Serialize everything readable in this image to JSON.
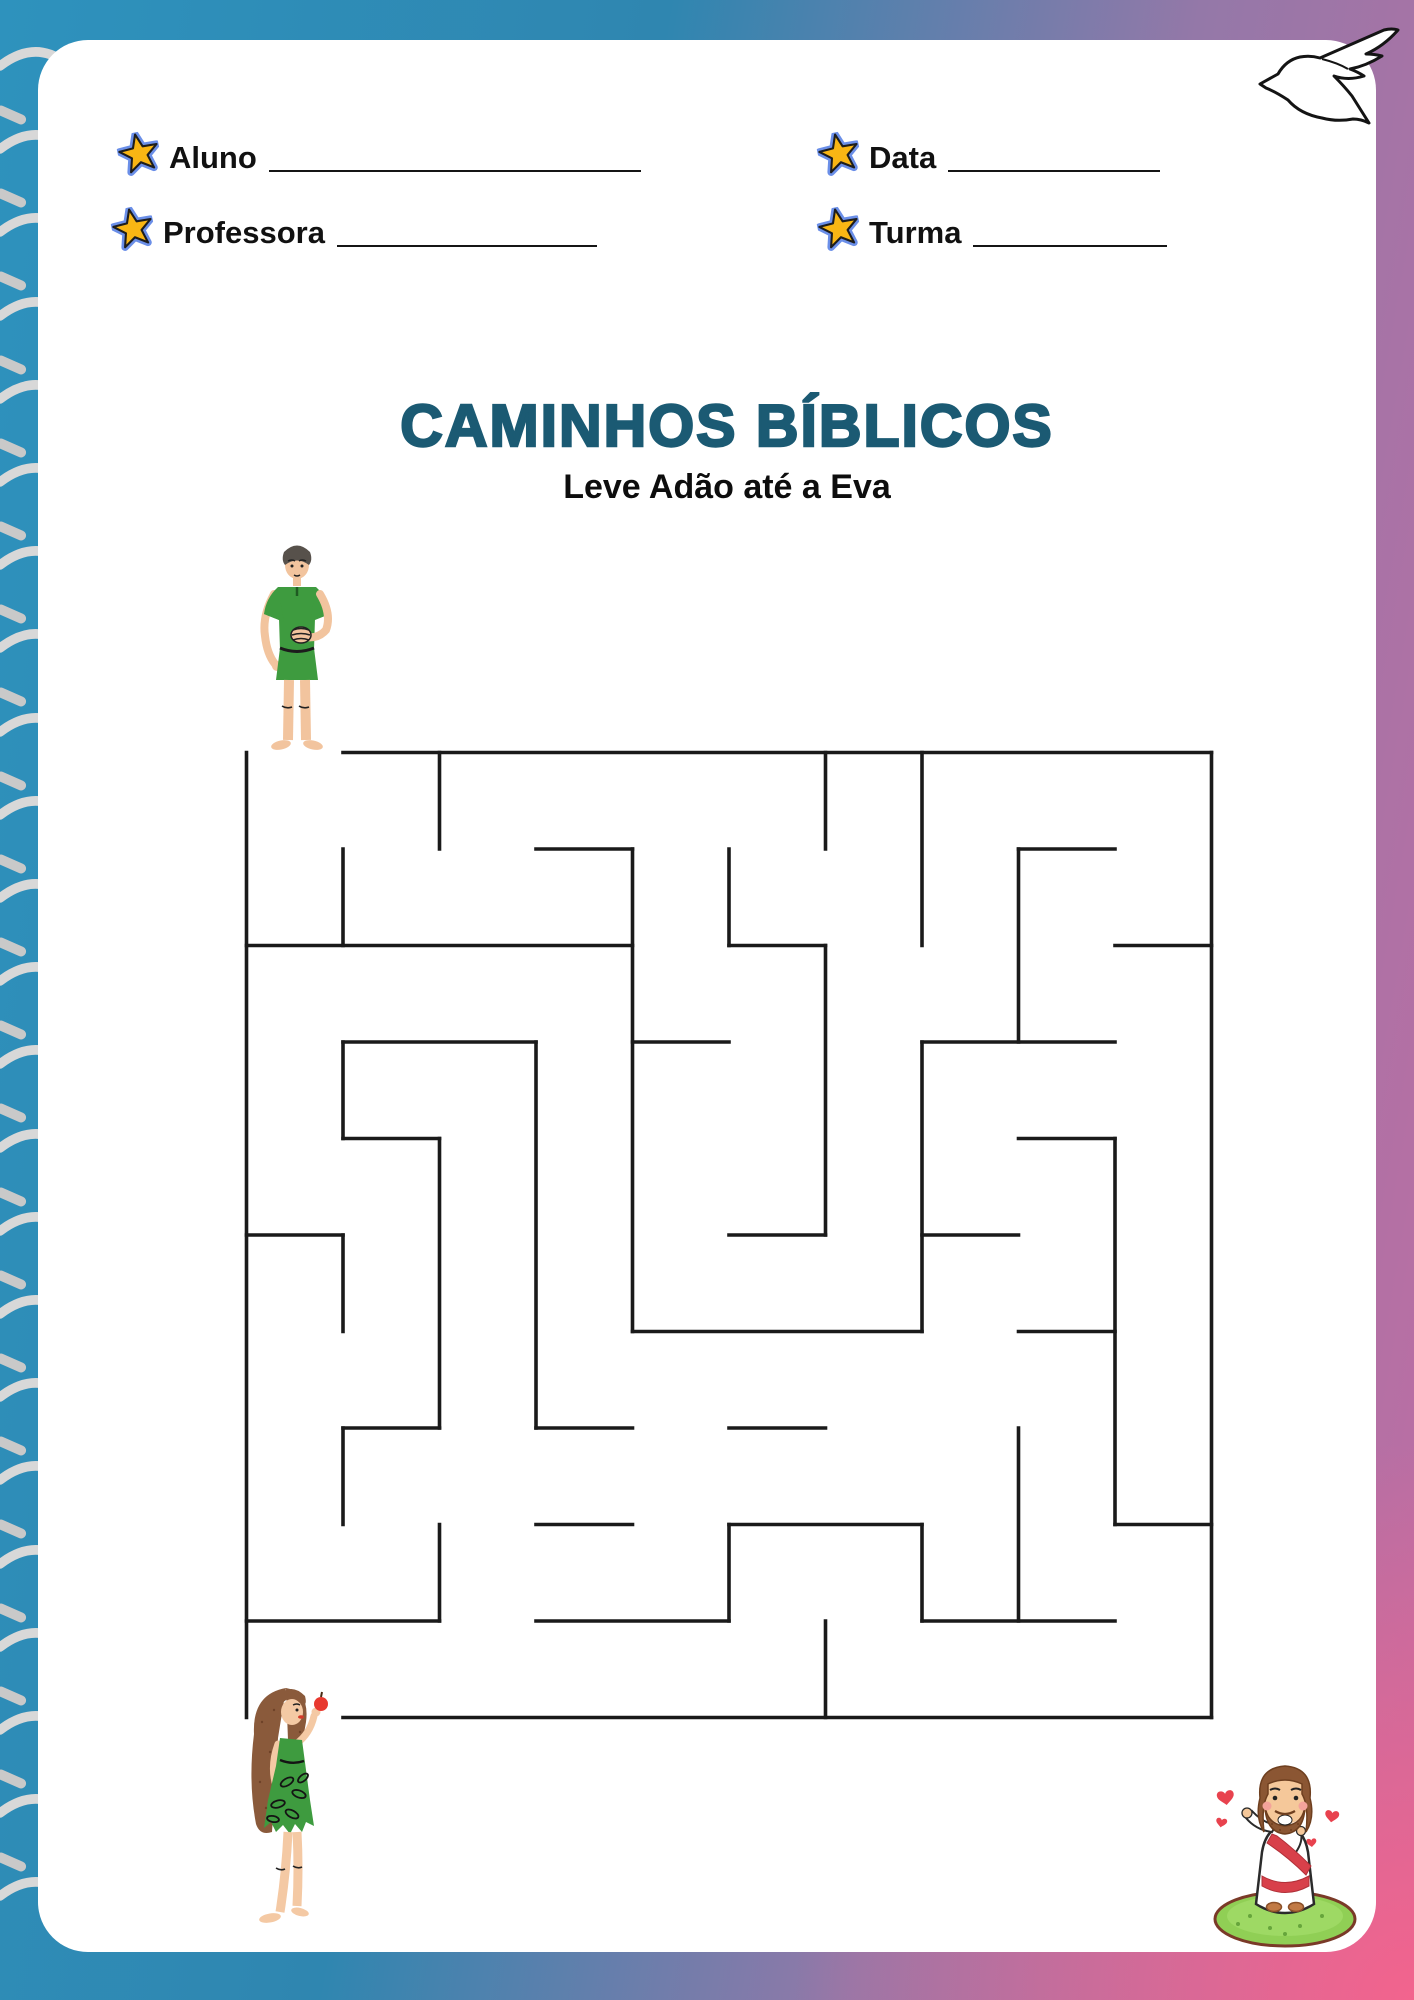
{
  "doc": {
    "kind": "printable-maze-worksheet",
    "language": "pt-BR"
  },
  "colors": {
    "bg_blue": "#2E92BD",
    "bg_pink_muted": "#C06DA3",
    "bg_pink_vivid": "#F5638C",
    "paper": "#FFFFFF",
    "title_teal": "#1B5A73",
    "text": "#111111",
    "maze_wall": "#1A1A1A",
    "star_fill": "#F9B614",
    "star_ring": "#6B8FE8",
    "wire": "#D8D8D8",
    "ring_hole": "#141414",
    "tunic_green": "#3E9B3F",
    "skin": "#F2C49E",
    "apple_red": "#E8392F",
    "heart_red": "#E8424E",
    "sash_red": "#D8404A",
    "grass_green": "#90CF55"
  },
  "header": {
    "fields": [
      {
        "id": "aluno",
        "label": "Aluno"
      },
      {
        "id": "professora",
        "label": "Professora"
      },
      {
        "id": "data",
        "label": "Data"
      },
      {
        "id": "turma",
        "label": "Turma"
      }
    ]
  },
  "title": "CAMINHOS BÍBLICOS",
  "subtitle": "Leve Adão até a Eva",
  "maze": {
    "cols": 10,
    "rows": 10,
    "cell": 96.5,
    "entrance": "top-left (above first column, Adam)",
    "exit": "bottom-left (below first column, Eve)",
    "h_walls": [
      [
        0,
        1,
        10
      ],
      [
        1,
        3,
        4
      ],
      [
        1,
        8,
        9
      ],
      [
        2,
        0,
        4
      ],
      [
        2,
        5,
        6
      ],
      [
        2,
        9,
        10
      ],
      [
        3,
        1,
        3
      ],
      [
        3,
        4,
        5
      ],
      [
        3,
        7,
        9
      ],
      [
        4,
        1,
        2
      ],
      [
        4,
        8,
        9
      ],
      [
        5,
        0,
        1
      ],
      [
        5,
        5,
        6
      ],
      [
        5,
        7,
        8
      ],
      [
        6,
        4,
        7
      ],
      [
        6,
        8,
        9
      ],
      [
        7,
        1,
        2
      ],
      [
        7,
        3,
        4
      ],
      [
        7,
        5,
        6
      ],
      [
        8,
        3,
        4
      ],
      [
        8,
        5,
        7
      ],
      [
        8,
        9,
        10
      ],
      [
        9,
        0,
        2
      ],
      [
        9,
        3,
        5
      ],
      [
        9,
        7,
        9
      ],
      [
        10,
        1,
        10
      ]
    ],
    "v_walls": [
      [
        0,
        0,
        10
      ],
      [
        1,
        1,
        2
      ],
      [
        1,
        3,
        4
      ],
      [
        1,
        5,
        6
      ],
      [
        1,
        7,
        8
      ],
      [
        2,
        0,
        1
      ],
      [
        2,
        4,
        7
      ],
      [
        2,
        8,
        9
      ],
      [
        3,
        3,
        7
      ],
      [
        4,
        1,
        6
      ],
      [
        5,
        1,
        2
      ],
      [
        5,
        8,
        9
      ],
      [
        6,
        0,
        1
      ],
      [
        6,
        2,
        5
      ],
      [
        6,
        9,
        10
      ],
      [
        7,
        0,
        2
      ],
      [
        7,
        3,
        6
      ],
      [
        7,
        8,
        9
      ],
      [
        8,
        1,
        3
      ],
      [
        8,
        7,
        9
      ],
      [
        9,
        4,
        8
      ],
      [
        10,
        0,
        10
      ]
    ]
  },
  "characters": {
    "start": "Adão",
    "goal": "Eva",
    "corner_decor": "Jesus"
  },
  "decor": {
    "spiral_rings": 23,
    "dove": "dove-icon"
  }
}
